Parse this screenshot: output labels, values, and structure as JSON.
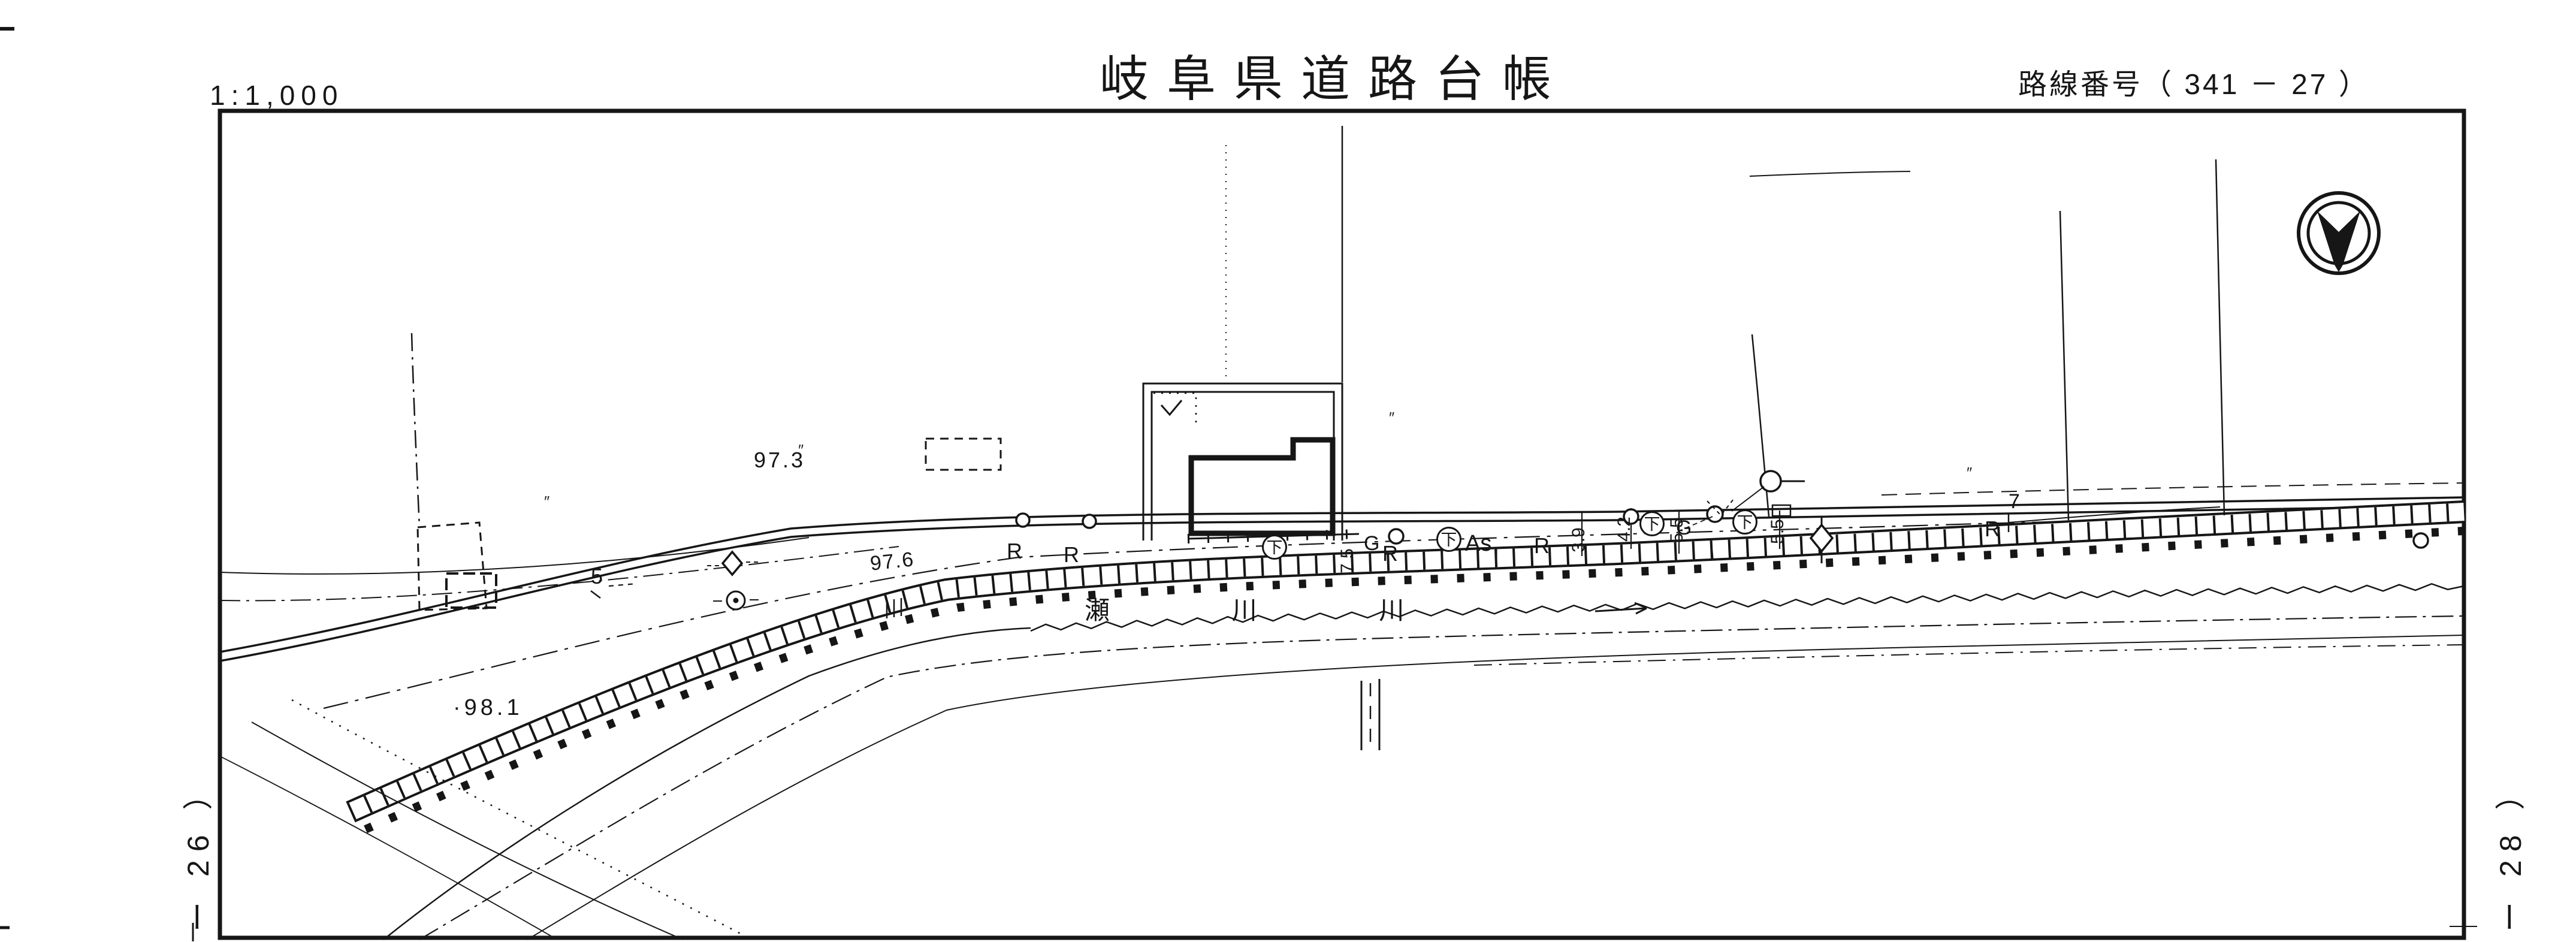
{
  "page": {
    "paper_color": "#ffffff",
    "ink_color": "#161616"
  },
  "header": {
    "scale_label": "1:1,000",
    "title": "岐阜県道路台帳",
    "route_label": "路線番号（ 341 － 27 ）"
  },
  "sheet_refs": {
    "left": "ー 26 ）",
    "right": "ー 28 ）"
  },
  "icons": {
    "north_symbol": "circled-north-arrow"
  },
  "map": {
    "river_name": "瀬川川",
    "river_name_spaced": "瀬 川 川",
    "elevation_labels": [
      "97.3",
      "97.6",
      "·98.1"
    ],
    "roadside_marks": [
      "R",
      "R",
      "R",
      "R",
      "R"
    ],
    "pavement_label": "As",
    "gutter_marks": [
      "G",
      "G"
    ],
    "utility_circle_label": "下",
    "dimension_labels": [
      "5",
      "7.5",
      "3.9",
      "4.2",
      "5.5",
      "5.5",
      "7"
    ],
    "ditto_marks": [
      "″",
      "″",
      "″",
      "″"
    ]
  }
}
